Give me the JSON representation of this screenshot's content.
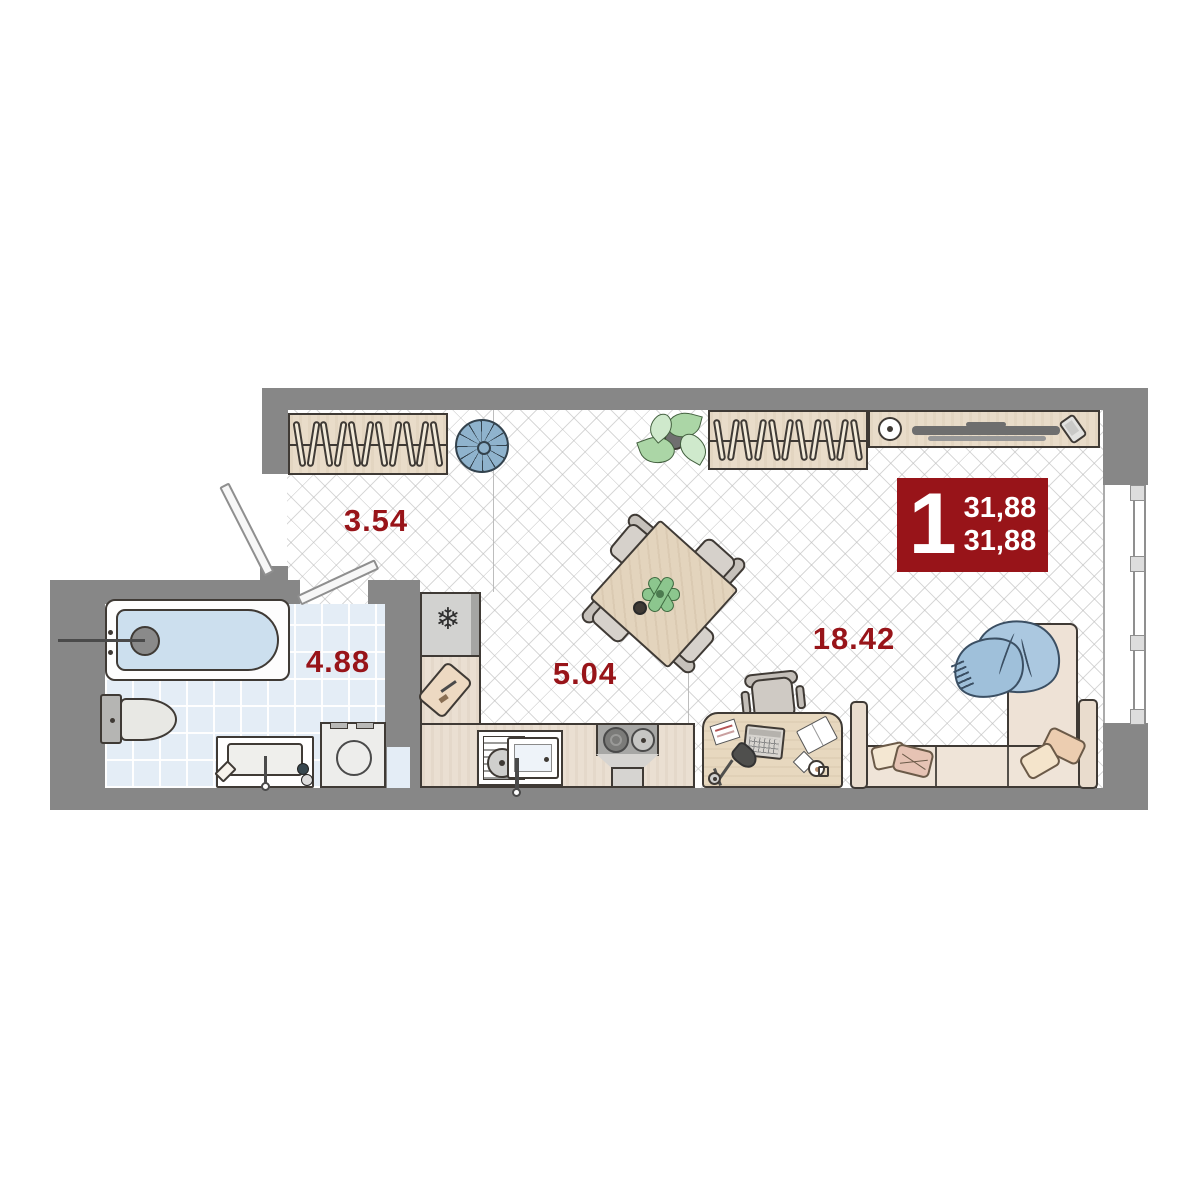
{
  "badge": {
    "rooms_count": "1",
    "area_line1": "31,88",
    "area_line2": "31,88",
    "bg_color": "#981419",
    "text_color": "#ffffff"
  },
  "rooms": {
    "hallway": {
      "area": "3.54"
    },
    "bathroom": {
      "area": "4.88"
    },
    "kitchen": {
      "area": "5.04"
    },
    "living": {
      "area": "18.42"
    }
  },
  "icons": {
    "snowflake": "❄"
  },
  "colors": {
    "accent_red": "#981419",
    "wall_gray": "#878787",
    "tile_blue": "#e4edf6",
    "wood_beige": "#e9dcc9",
    "water_blue": "#ccdfee",
    "pouf_blue": "#8fb3cd",
    "blanket_blue": "#abc8e0"
  }
}
